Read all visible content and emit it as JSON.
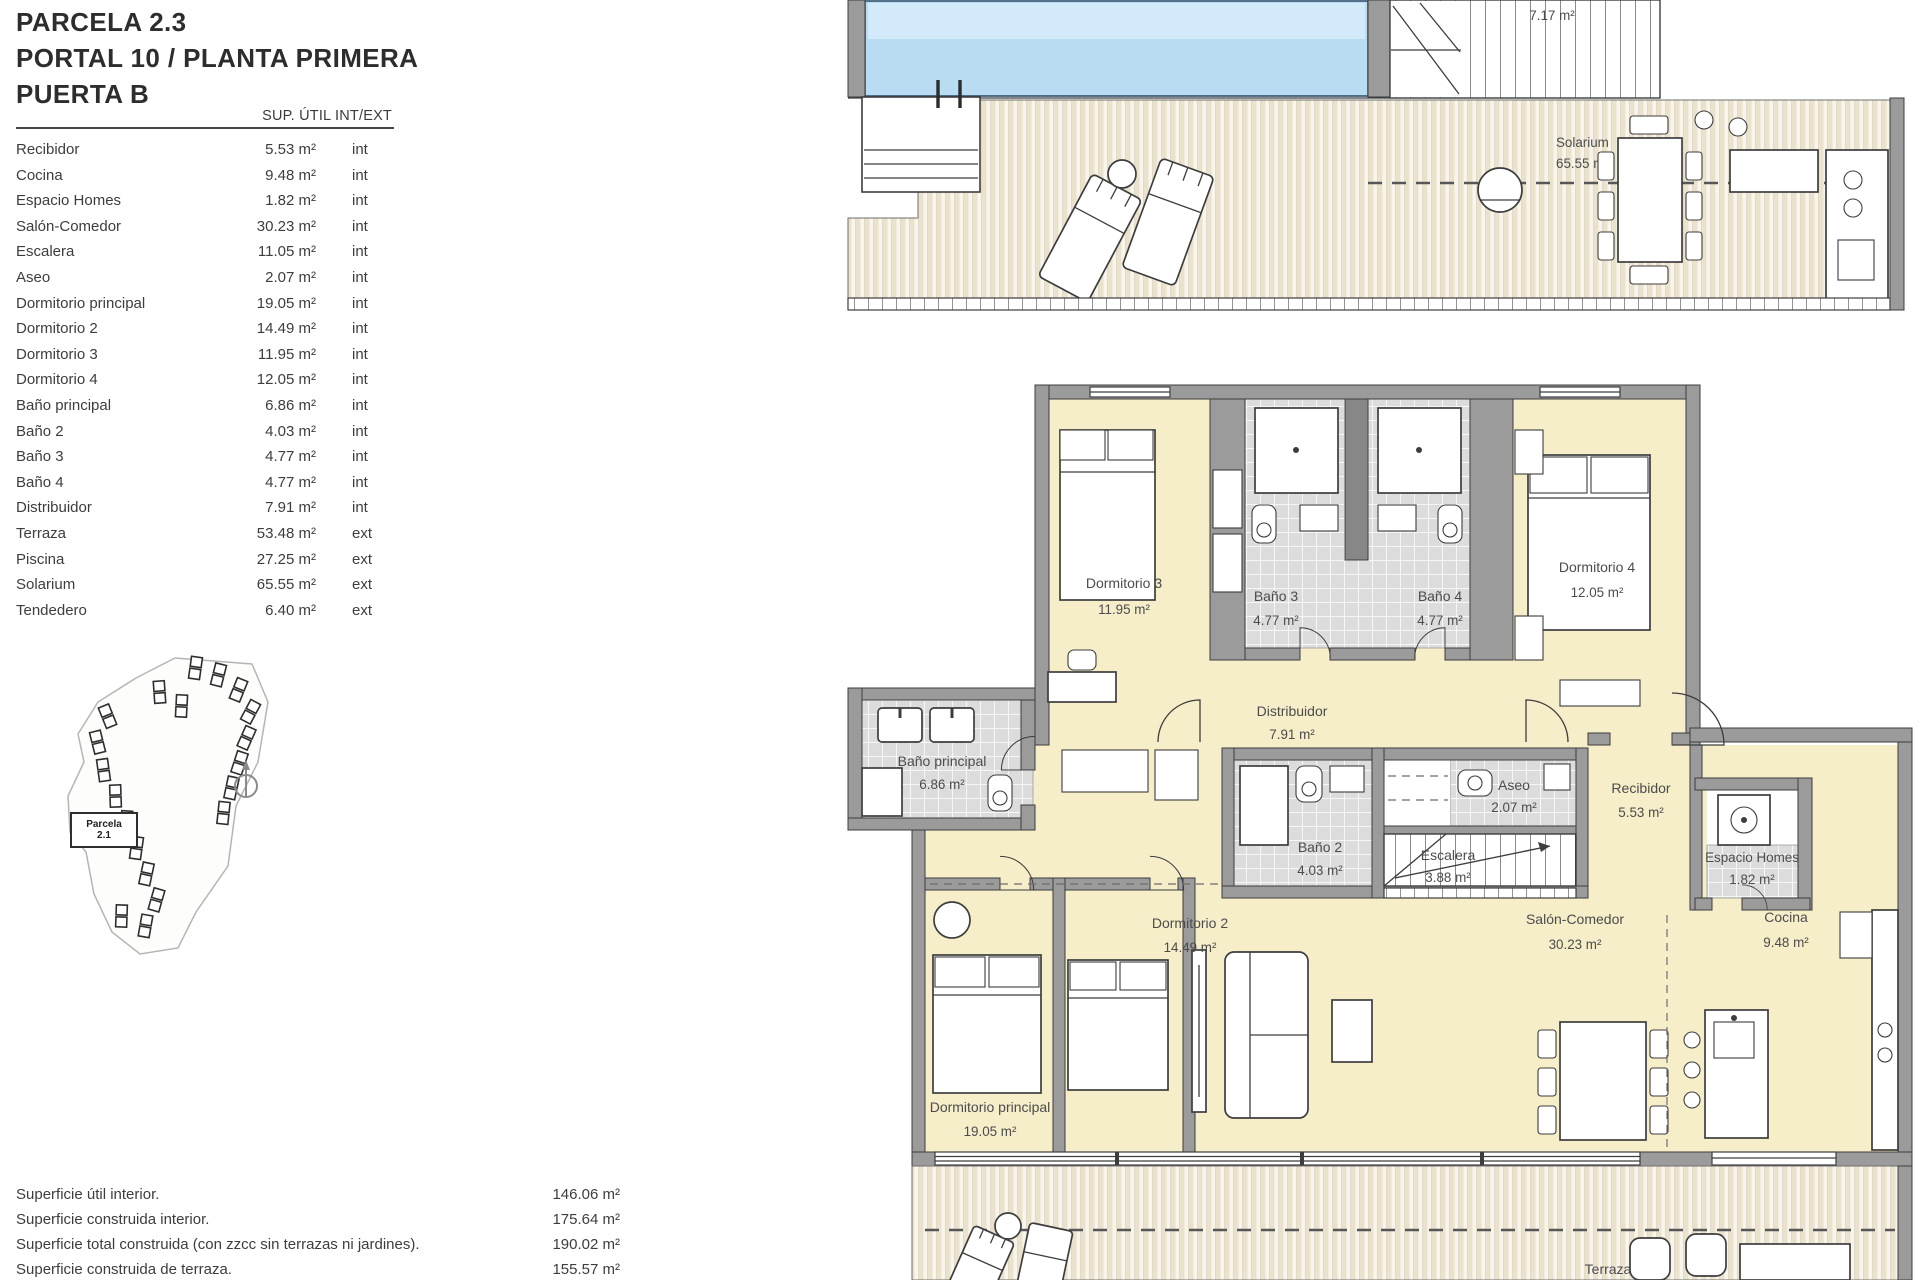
{
  "colors": {
    "pool-blue": "#b9dcf2",
    "pool-light": "#d2eaf9",
    "room-cream": "#f6edc9",
    "wall-gray": "#9b9b9b",
    "tile-gray": "#dcdcdc",
    "deck-beige": "#eae2cd",
    "deck-white": "#f8f5ec",
    "line-dark": "#3d3d3d",
    "text-gray": "#4c4c4c",
    "text-dark": "#2d2d2d"
  },
  "header": {
    "line1": "PARCELA 2.3",
    "line2": "PORTAL 10 / PLANTA PRIMERA",
    "line3": "PUERTA B"
  },
  "areas_table": {
    "col_header": "SUP. ÚTIL INT/EXT",
    "rows": [
      {
        "name": "Recibidor",
        "area": "5.53 m²",
        "type": "int"
      },
      {
        "name": "Cocina",
        "area": "9.48 m²",
        "type": "int"
      },
      {
        "name": "Espacio Homes",
        "area": "1.82 m²",
        "type": "int"
      },
      {
        "name": "Salón-Comedor",
        "area": "30.23 m²",
        "type": "int"
      },
      {
        "name": "Escalera",
        "area": "11.05 m²",
        "type": "int"
      },
      {
        "name": "Aseo",
        "area": "2.07 m²",
        "type": "int"
      },
      {
        "name": "Dormitorio principal",
        "area": "19.05 m²",
        "type": "int"
      },
      {
        "name": "Dormitorio 2",
        "area": "14.49 m²",
        "type": "int"
      },
      {
        "name": "Dormitorio 3",
        "area": "11.95 m²",
        "type": "int"
      },
      {
        "name": "Dormitorio 4",
        "area": "12.05 m²",
        "type": "int"
      },
      {
        "name": "Baño principal",
        "area": "6.86 m²",
        "type": "int"
      },
      {
        "name": "Baño 2",
        "area": "4.03 m²",
        "type": "int"
      },
      {
        "name": "Baño 3",
        "area": "4.77 m²",
        "type": "int"
      },
      {
        "name": "Baño 4",
        "area": "4.77 m²",
        "type": "int"
      },
      {
        "name": "Distribuidor",
        "area": "7.91 m²",
        "type": "int"
      },
      {
        "name": "Terraza",
        "area": "53.48 m²",
        "type": "ext"
      },
      {
        "name": "Piscina",
        "area": "27.25 m²",
        "type": "ext"
      },
      {
        "name": "Solarium",
        "area": "65.55 m²",
        "type": "ext"
      },
      {
        "name": "Tendedero",
        "area": "6.40 m²",
        "type": "ext"
      }
    ]
  },
  "site_plan": {
    "parcel_line1": "Parcela",
    "parcel_line2": "2.1"
  },
  "summary_rows": [
    {
      "label": "Superficie útil interior.",
      "value": "146.06 m²"
    },
    {
      "label": "Superficie construida interior.",
      "value": "175.64 m²"
    },
    {
      "label": "Superficie total construida (con zzcc sin terrazas ni jardines).",
      "value": "190.02 m²"
    },
    {
      "label": "Superficie construida de terraza.",
      "value": "155.57 m²"
    }
  ],
  "solarium_plan": {
    "stairs_area": "7.17 m²",
    "solarium_name": "Solarium",
    "solarium_area": "65.55 m²"
  },
  "floor_plan": {
    "dormitorio3": {
      "name": "Dormitorio 3",
      "area": "11.95 m²"
    },
    "bano3": {
      "name": "Baño 3",
      "area": "4.77 m²"
    },
    "bano4": {
      "name": "Baño 4",
      "area": "4.77 m²"
    },
    "dormitorio4": {
      "name": "Dormitorio 4",
      "area": "12.05 m²"
    },
    "distribuidor": {
      "name": "Distribuidor",
      "area": "7.91 m²"
    },
    "bano_principal": {
      "name": "Baño principal",
      "area": "6.86 m²"
    },
    "bano2": {
      "name": "Baño 2",
      "area": "4.03 m²"
    },
    "escalera": {
      "name": "Escalera",
      "area": "3.88 m²"
    },
    "aseo": {
      "name": "Aseo",
      "area": "2.07 m²"
    },
    "recibidor": {
      "name": "Recibidor",
      "area": "5.53 m²"
    },
    "espacio_homes": {
      "name": "Espacio Homes",
      "area": "1.82 m²"
    },
    "cocina": {
      "name": "Cocina",
      "area": "9.48 m²"
    },
    "salon": {
      "name": "Salón-Comedor",
      "area": "30.23 m²"
    },
    "dormitorio2": {
      "name": "Dormitorio 2",
      "area": "14.49 m²"
    },
    "dormitorio_principal": {
      "name": "Dormitorio principal",
      "area": "19.05 m²"
    },
    "terraza": {
      "name": "Terraza"
    }
  }
}
